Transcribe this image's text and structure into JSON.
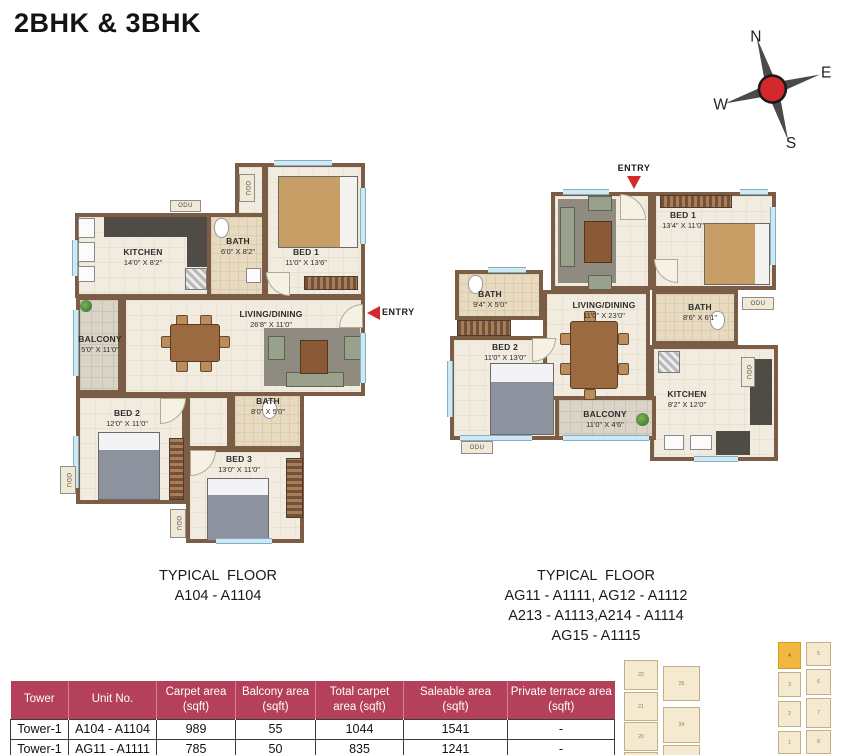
{
  "title": "2BHK & 3BHK",
  "compass": {
    "north": "N",
    "east": "E",
    "south": "S",
    "west": "W"
  },
  "labels": {
    "entry": "ENTRY",
    "odu": "ODU"
  },
  "colors": {
    "accent_red": "#d5282c",
    "table_header_bg": "#b54059",
    "wall_brown": "#7b5c45",
    "floor_cream": "#f1ecdf",
    "keyplan_highlight": "#f2b73f"
  },
  "plans": {
    "left": {
      "caption": [
        "TYPICAL  FLOOR",
        "A104 - A1104"
      ],
      "rooms": [
        {
          "name": "KITCHEN",
          "dim": "14'0\" X 8'2\""
        },
        {
          "name": "BATH",
          "dim": "6'0\" X 8'2\""
        },
        {
          "name": "BED 1",
          "dim": "11'0\" X 13'6\""
        },
        {
          "name": "LIVING/DINING",
          "dim": "26'8\" X 11'0\""
        },
        {
          "name": "BALCONY",
          "dim": "5'0\" X 11'0\""
        },
        {
          "name": "BED 2",
          "dim": "12'0\" X 11'0\""
        },
        {
          "name": "BATH",
          "dim": "8'0\" X 5'0\""
        },
        {
          "name": "BED 3",
          "dim": "13'0\" X 11'0\""
        }
      ]
    },
    "right": {
      "caption": [
        "TYPICAL  FLOOR",
        "AG11 - A1111, AG12 - A1112",
        "A213 - A1113,A214 - A1114",
        "AG15 - A1115"
      ],
      "rooms": [
        {
          "name": "BED 1",
          "dim": "13'4\" X 11'0\""
        },
        {
          "name": "BATH",
          "dim": "9'4\" X 5'0\""
        },
        {
          "name": "LIVING/DINING",
          "dim": "11'0\" X 23'0\""
        },
        {
          "name": "BATH",
          "dim": "8'6\" X 6'1\""
        },
        {
          "name": "BED 2",
          "dim": "11'0\" X 13'0\""
        },
        {
          "name": "BALCONY",
          "dim": "11'0\" X 4'6\""
        },
        {
          "name": "KITCHEN",
          "dim": "8'2\" X 12'0\""
        }
      ]
    }
  },
  "table": {
    "headers": [
      "Tower",
      "Unit No.",
      "Carpet area (sqft)",
      "Balcony area (sqft)",
      "Total carpet area (sqft)",
      "Saleable area (sqft)",
      "Private terrace area (sqft)"
    ],
    "rows": [
      [
        "Tower-1",
        "A104 - A1104",
        "989",
        "55",
        "1044",
        "1541",
        "-"
      ],
      [
        "Tower-1",
        "AG11 - A1111",
        "785",
        "50",
        "835",
        "1241",
        "-"
      ]
    ]
  },
  "keyplan": {
    "blocks": [
      "22",
      "21",
      "20",
      "19",
      "25",
      "24",
      "26",
      "4",
      "3",
      "2",
      "1",
      "5",
      "6",
      "7",
      "8"
    ],
    "highlighted_block": "4"
  }
}
